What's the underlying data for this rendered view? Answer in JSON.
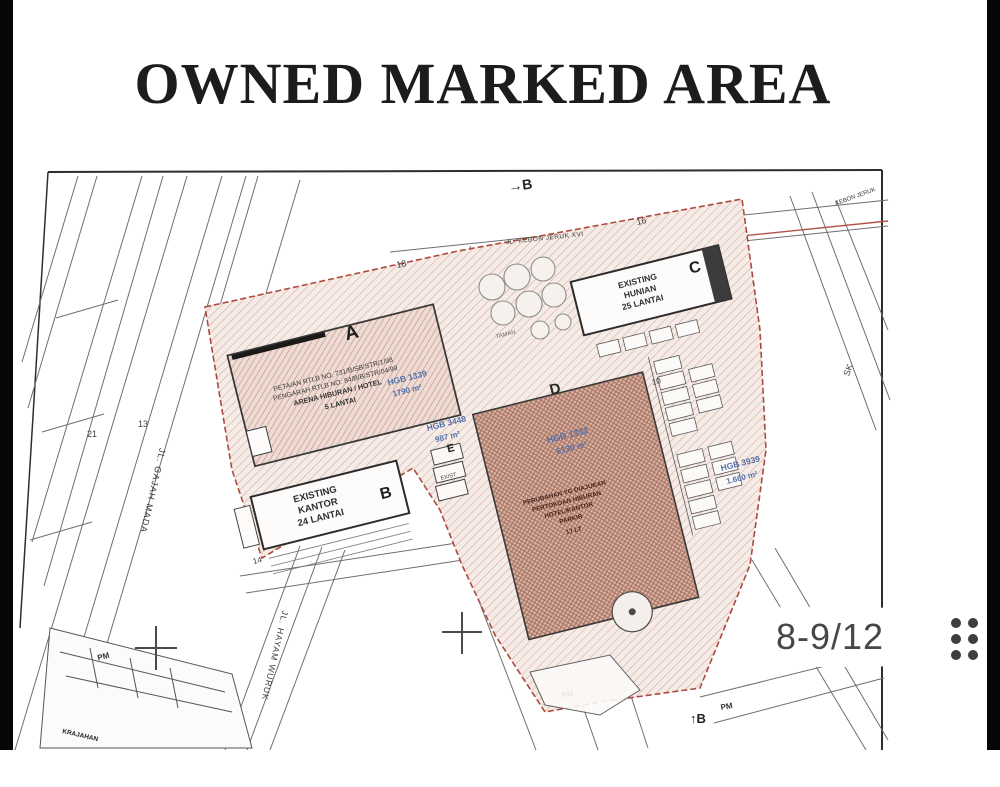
{
  "page": {
    "title": "OWNED MARKED AREA"
  },
  "viewer": {
    "page_badge": "8-9/12",
    "menu_icon": "grid-dots-icon",
    "badge_text_color": "#474747"
  },
  "map": {
    "colors": {
      "boundary_red": "#ad4a3e",
      "hgb_blue": "#5570a8",
      "hatch_light": "#d3a79b",
      "hatch_building_a": "#c08d80",
      "hatch_area_d": "#a8715f"
    },
    "streets": {
      "gajah_mada": "JL. GAJAH MADA",
      "hayam_wuruk": "JL. HAYAM WURUK",
      "kebon_jeruk": "JL. KEBON JERUK XVI",
      "kebon_jeruk_short": "KEBON JERUK"
    },
    "sections": {
      "top": "→B",
      "bottom": "↑B"
    },
    "buildings": {
      "a": {
        "label": "A",
        "text1": "PETA/AN RTLB NO. 731/B/SB/STR/1/98",
        "text2": "PENGARAH RTLB NO. 84/B/B/STR/04/99",
        "text3": "ARENA HIBURAN / HOTEL",
        "text4": "5 LANTAI",
        "hgb": "HGB 1339",
        "area": "1790 m²"
      },
      "b": {
        "label": "B",
        "text1": "EXISTING",
        "text2": "KANTOR",
        "text3": "24 LANTAI"
      },
      "c": {
        "label": "C",
        "text1": "EXISTING",
        "text2": "HUNIAN",
        "text3": "25 LANTAI"
      },
      "d": {
        "label": "D",
        "hgb": "HGB 1332",
        "area": "6130 m²",
        "text1": "PERUBAHAN YG DIAJUKAN",
        "text2": "PERTOKOAN HIBURAN",
        "text3": "HOTEL/KANTOR",
        "text4": "PARKIR",
        "text5": "17 LT"
      },
      "e": {
        "label": "E",
        "text1": "EXIST"
      }
    },
    "parcels": {
      "hgb3448": {
        "name": "HGB 3448",
        "area": "987 m²"
      },
      "hgb3939": {
        "name": "HGB 3939",
        "area": "1.660 m²"
      }
    },
    "labels": {
      "taman": "TAMAN",
      "krajahan": "KRAJAHAN",
      "pm": "PM",
      "sk": "SK"
    },
    "numbers": {
      "n21": "21",
      "n13": "13",
      "n18": "18",
      "n16": "16",
      "n10": "10",
      "n14": "14"
    }
  }
}
